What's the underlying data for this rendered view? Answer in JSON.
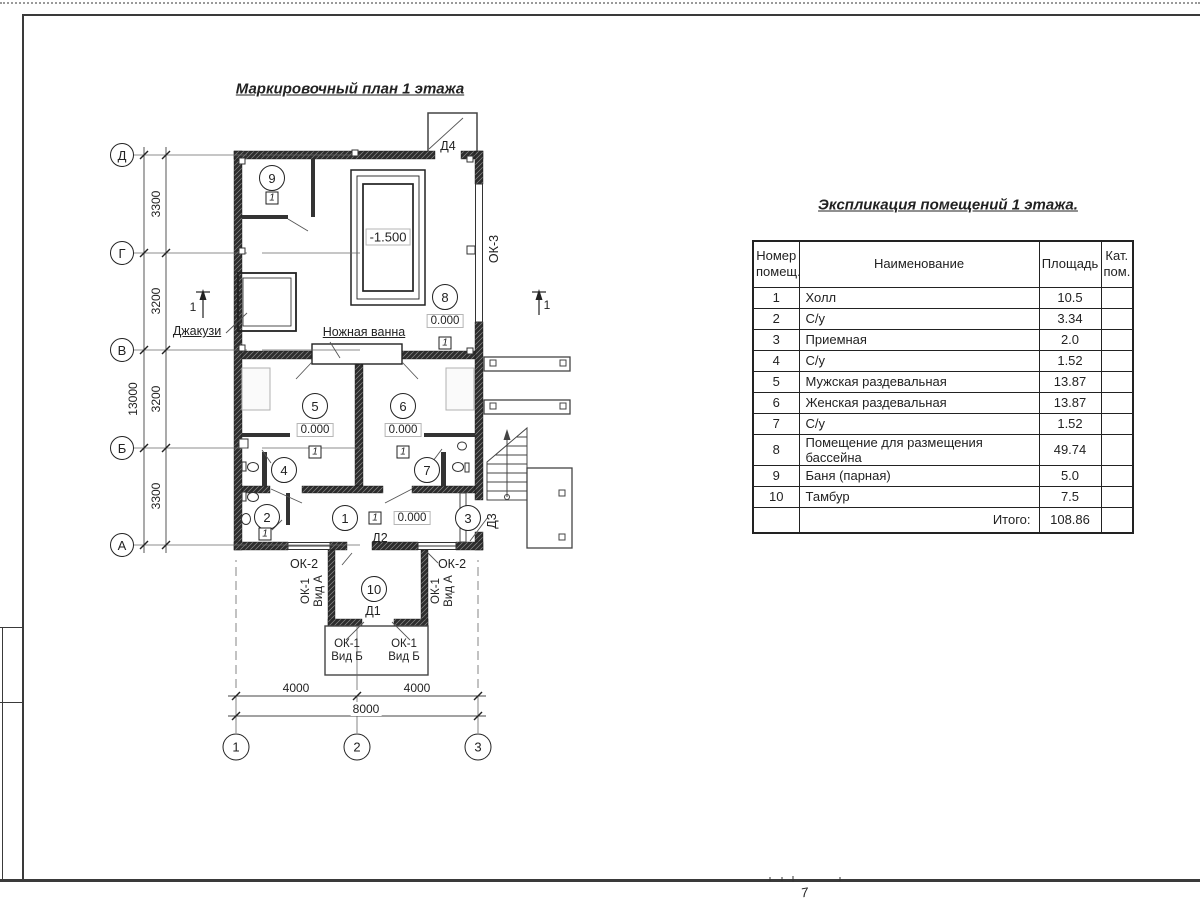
{
  "page": {
    "number": "7"
  },
  "plan": {
    "title": "Маркировочный план 1 этажа",
    "axes_left": [
      "Д",
      "Г",
      "В",
      "Б",
      "А"
    ],
    "axes_bottom": [
      "1",
      "2",
      "3"
    ],
    "dims_left": [
      "3300",
      "3200",
      "3200",
      "3300"
    ],
    "dim_left_total": "13000",
    "dims_bottom": [
      "4000",
      "4000"
    ],
    "dim_bottom_total": "8000",
    "section_mark": "1",
    "marker": "1",
    "levels": {
      "pool": "-1.500",
      "zero": "0.000"
    },
    "labels": {
      "jacuzzi": "Джакузи",
      "foot_bath": "Ножная ванна",
      "d1": "Д1",
      "d2": "Д2",
      "d3": "Д3",
      "d4": "Д4",
      "ok2": "ОК-2",
      "ok3": "ОК-3",
      "ok1_vid_a": "ОК-1\nВид А",
      "ok1_vid_b": "ОК-1\nВид Б"
    },
    "rooms": [
      "1",
      "2",
      "3",
      "4",
      "5",
      "6",
      "7",
      "8",
      "9",
      "10"
    ]
  },
  "table": {
    "title": "Экспликация помещений 1 этажа.",
    "headers": [
      "Номер\nпомещ.",
      "Наименование",
      "Площадь",
      "Кат.\nпом."
    ],
    "rows": [
      [
        "1",
        "Холл",
        "10.5"
      ],
      [
        "2",
        "С/у",
        "3.34"
      ],
      [
        "3",
        "Приемная",
        "2.0"
      ],
      [
        "4",
        "С/у",
        "1.52"
      ],
      [
        "5",
        "Мужская раздевальная",
        "13.87"
      ],
      [
        "6",
        "Женская раздевальная",
        "13.87"
      ],
      [
        "7",
        "С/у",
        "1.52"
      ],
      [
        "8",
        "Помещение для размещения бассейна",
        "49.74"
      ],
      [
        "9",
        "Баня (парная)",
        "5.0"
      ],
      [
        "10",
        "Тамбур",
        "7.5"
      ]
    ],
    "total_label": "Итого:",
    "total_value": "108.86"
  }
}
